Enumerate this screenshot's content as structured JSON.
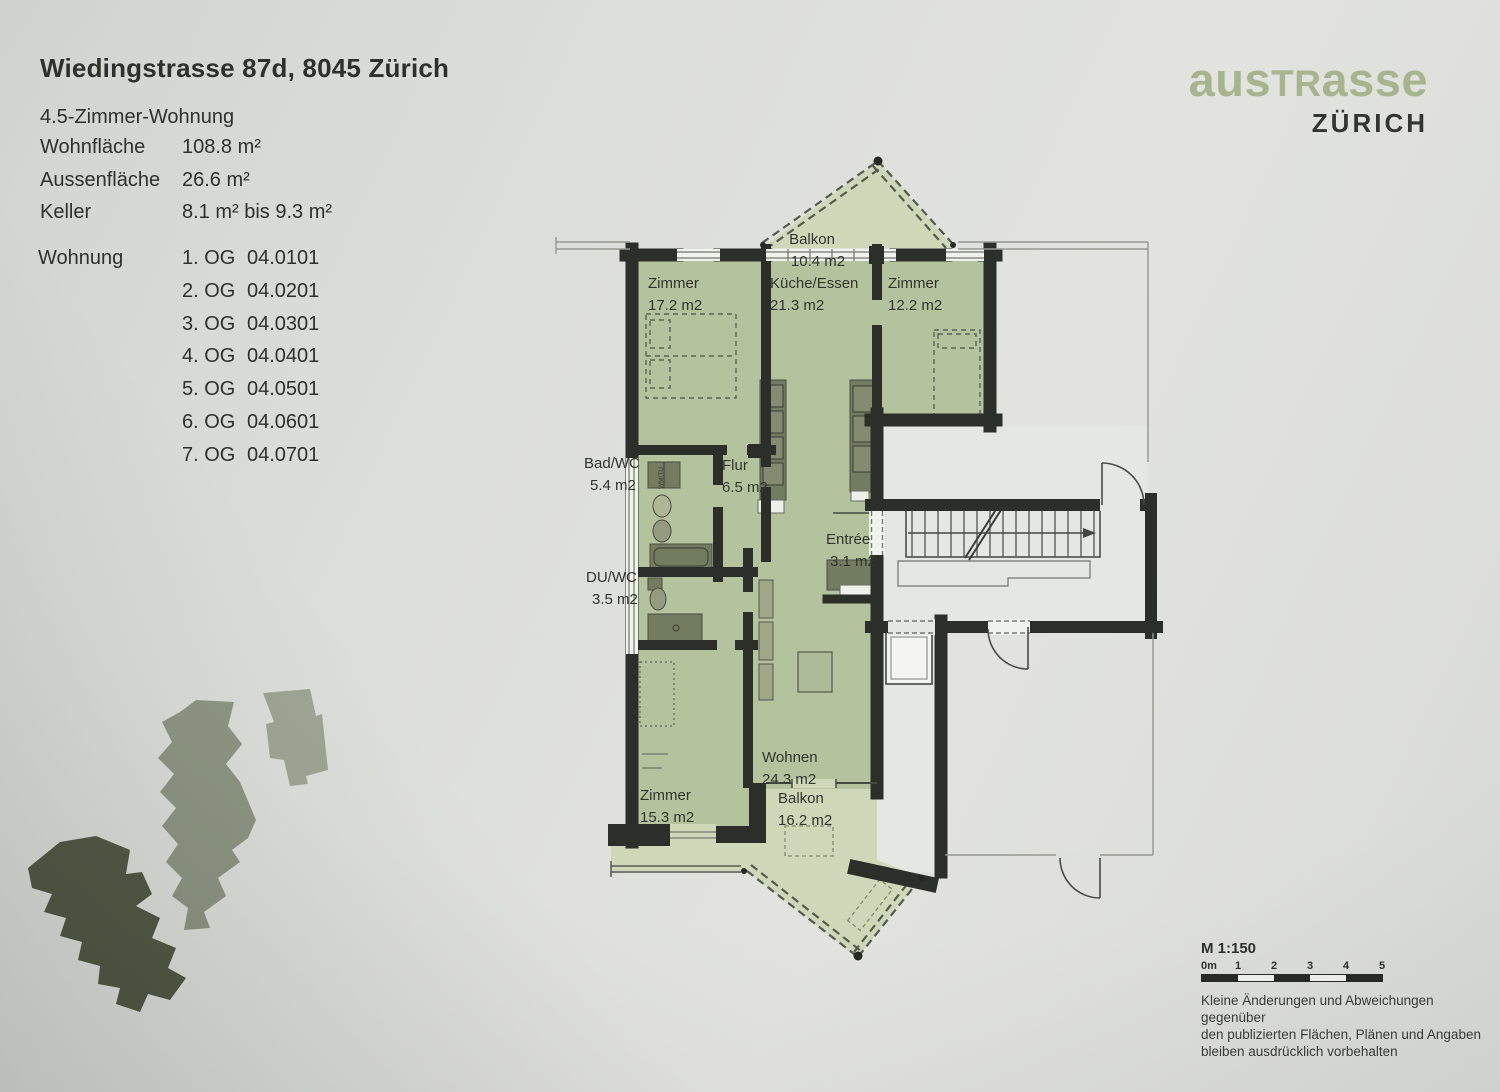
{
  "header": {
    "title": "Wiedingstrasse 87d, 8045 Zürich",
    "apartment_type": "4.5-Zimmer-Wohnung",
    "specs": [
      {
        "label": "Wohnfläche",
        "value": "108.8 m²"
      },
      {
        "label": "Aussenfläche",
        "value": "26.6 m²"
      },
      {
        "label": "Keller",
        "value": "8.1 m² bis 9.3 m²"
      }
    ],
    "wohnung_label": "Wohnung",
    "units": [
      {
        "floor": "1. OG",
        "code": "04.0101"
      },
      {
        "floor": "2. OG",
        "code": "04.0201"
      },
      {
        "floor": "3. OG",
        "code": "04.0301"
      },
      {
        "floor": "4. OG",
        "code": "04.0401"
      },
      {
        "floor": "5. OG",
        "code": "04.0501"
      },
      {
        "floor": "6. OG",
        "code": "04.0601"
      },
      {
        "floor": "7. OG",
        "code": "04.0701"
      }
    ]
  },
  "logo": {
    "brand_pre": "aus",
    "brand_caps": "TR",
    "brand_post": "asse",
    "city": "ZÜRICH"
  },
  "plan": {
    "rooms": [
      {
        "name": "Balkon",
        "area": "10.4 m2"
      },
      {
        "name": "Zimmer",
        "area": "17.2 m2"
      },
      {
        "name": "Küche/Essen",
        "area": "21.3 m2"
      },
      {
        "name": "Zimmer",
        "area": "12.2 m2"
      },
      {
        "name": "Bad/WC",
        "area": "5.4 m2"
      },
      {
        "name": "Flur",
        "area": "6.5 m2"
      },
      {
        "name": "DU/WC",
        "area": "3.5 m2"
      },
      {
        "name": "Entrée",
        "area": "3.1 m2"
      },
      {
        "name": "Zimmer",
        "area": "15.3 m2"
      },
      {
        "name": "Wohnen",
        "area": "24.3 m2"
      },
      {
        "name": "Balkon",
        "area": "16.2 m2"
      }
    ],
    "appliance_label": "WM/TU"
  },
  "footer": {
    "scale_label": "M 1:150",
    "scale_ticks": [
      "0m",
      "1",
      "2",
      "3",
      "4",
      "5"
    ],
    "disclaimer_lines": [
      "Kleine Änderungen und Abweichungen gegenüber",
      "den publizierten Flächen, Plänen und Angaben",
      "bleiben ausdrücklich vorbehalten"
    ]
  },
  "colors": {
    "accent_green": "#a2b088",
    "plan_interior": "#b1bf99",
    "plan_balcony": "#ccd6b5",
    "stairwell": "#e4e6e2",
    "wall": "#20231e",
    "furniture": "#6b7557"
  }
}
